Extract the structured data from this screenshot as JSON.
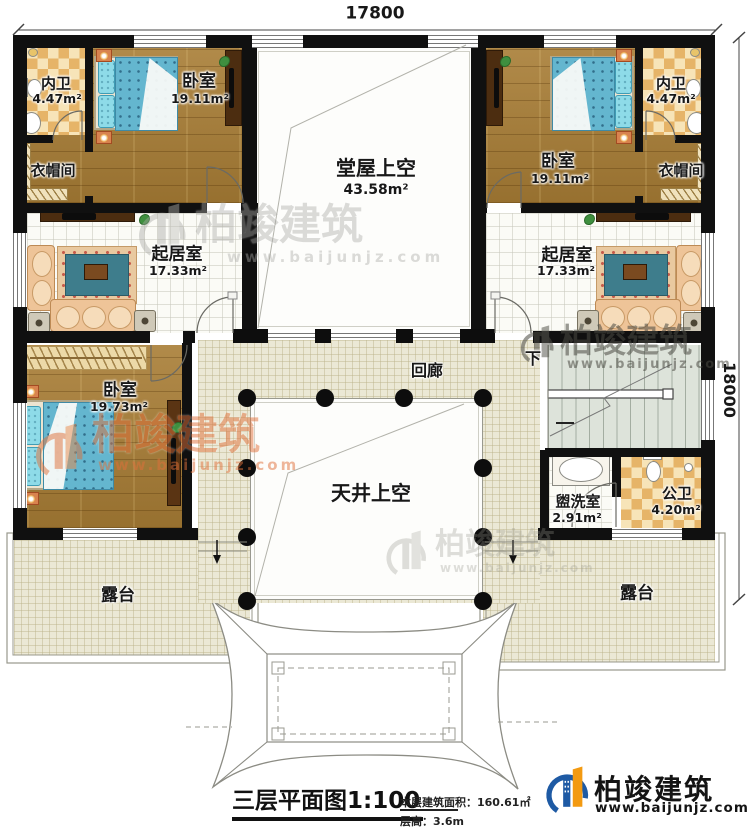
{
  "dimensions": {
    "top": "17800",
    "right": "18000"
  },
  "rooms": {
    "bath_tl": {
      "label": "内卫",
      "area": "4.47m²"
    },
    "bed_tl": {
      "label": "卧室",
      "area": "19.11m²"
    },
    "closet_tl": {
      "label": "衣帽间"
    },
    "hall_void": {
      "label": "堂屋上空",
      "area": "43.58m²"
    },
    "bed_tr": {
      "label": "卧室",
      "area": "19.11m²"
    },
    "bath_tr": {
      "label": "内卫",
      "area": "4.47m²"
    },
    "closet_tr": {
      "label": "衣帽间"
    },
    "living_left": {
      "label": "起居室",
      "area": "17.33m²"
    },
    "living_right": {
      "label": "起居室",
      "area": "17.33m²"
    },
    "bed_bl": {
      "label": "卧室",
      "area": "19.73m²"
    },
    "corridor": {
      "label": "回廊"
    },
    "courtyard_void": {
      "label": "天井上空"
    },
    "washroom": {
      "label": "盥洗室",
      "area": "2.91m²"
    },
    "wc": {
      "label": "公卫",
      "area": "4.20m²"
    },
    "terrace_left": {
      "label": "露台"
    },
    "terrace_right": {
      "label": "露台"
    },
    "stairs": {
      "down_label": "下"
    }
  },
  "titleblock": {
    "title": "三层平面图",
    "scale": "1:100",
    "area_note": "本层建筑面积：160.61㎡",
    "height_note": "层高：3.6m"
  },
  "brand": {
    "name": "柏竣建筑",
    "url": "www.baijunjz.com"
  },
  "watermark": {
    "name": "柏竣建筑",
    "url": "www.baijunjz.com"
  }
}
